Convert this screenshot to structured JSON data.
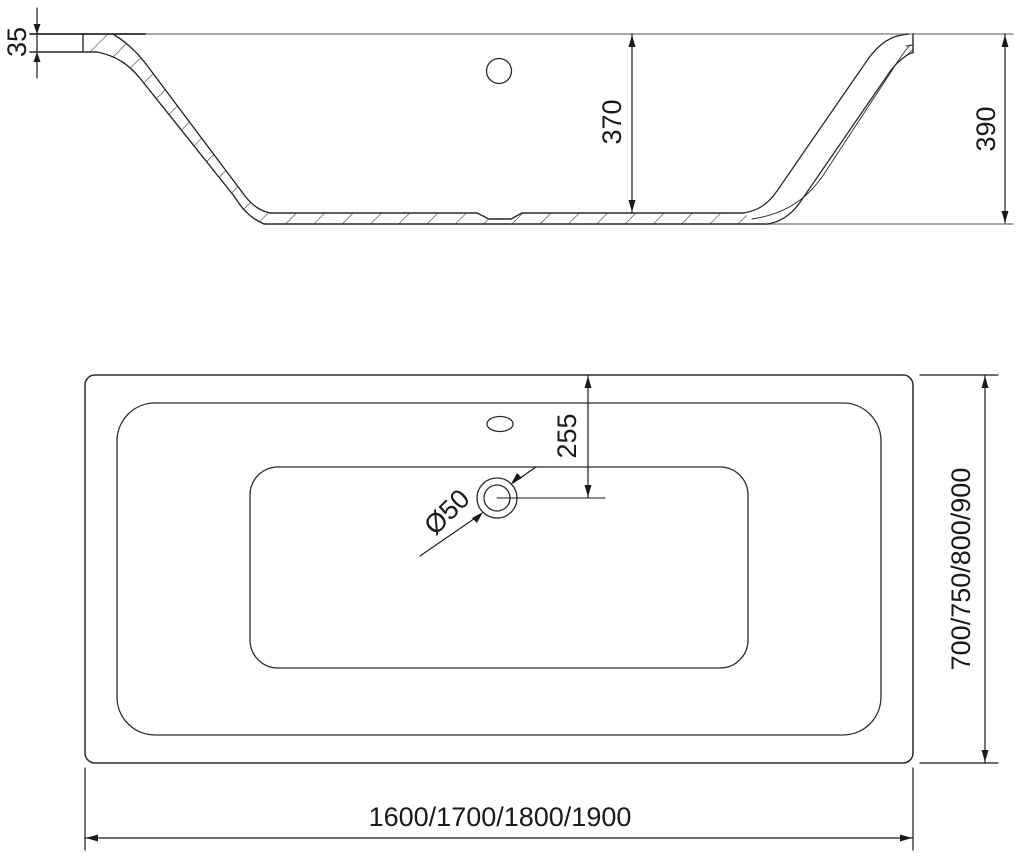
{
  "side_view": {
    "rim_thickness": "35",
    "inner_depth": "370",
    "total_height": "390"
  },
  "plan_view": {
    "drain_offset": "255",
    "drain_diameter": "Ø50",
    "length_options": "1600/1700/1800/1900",
    "width_options": "700/750/800/900"
  }
}
